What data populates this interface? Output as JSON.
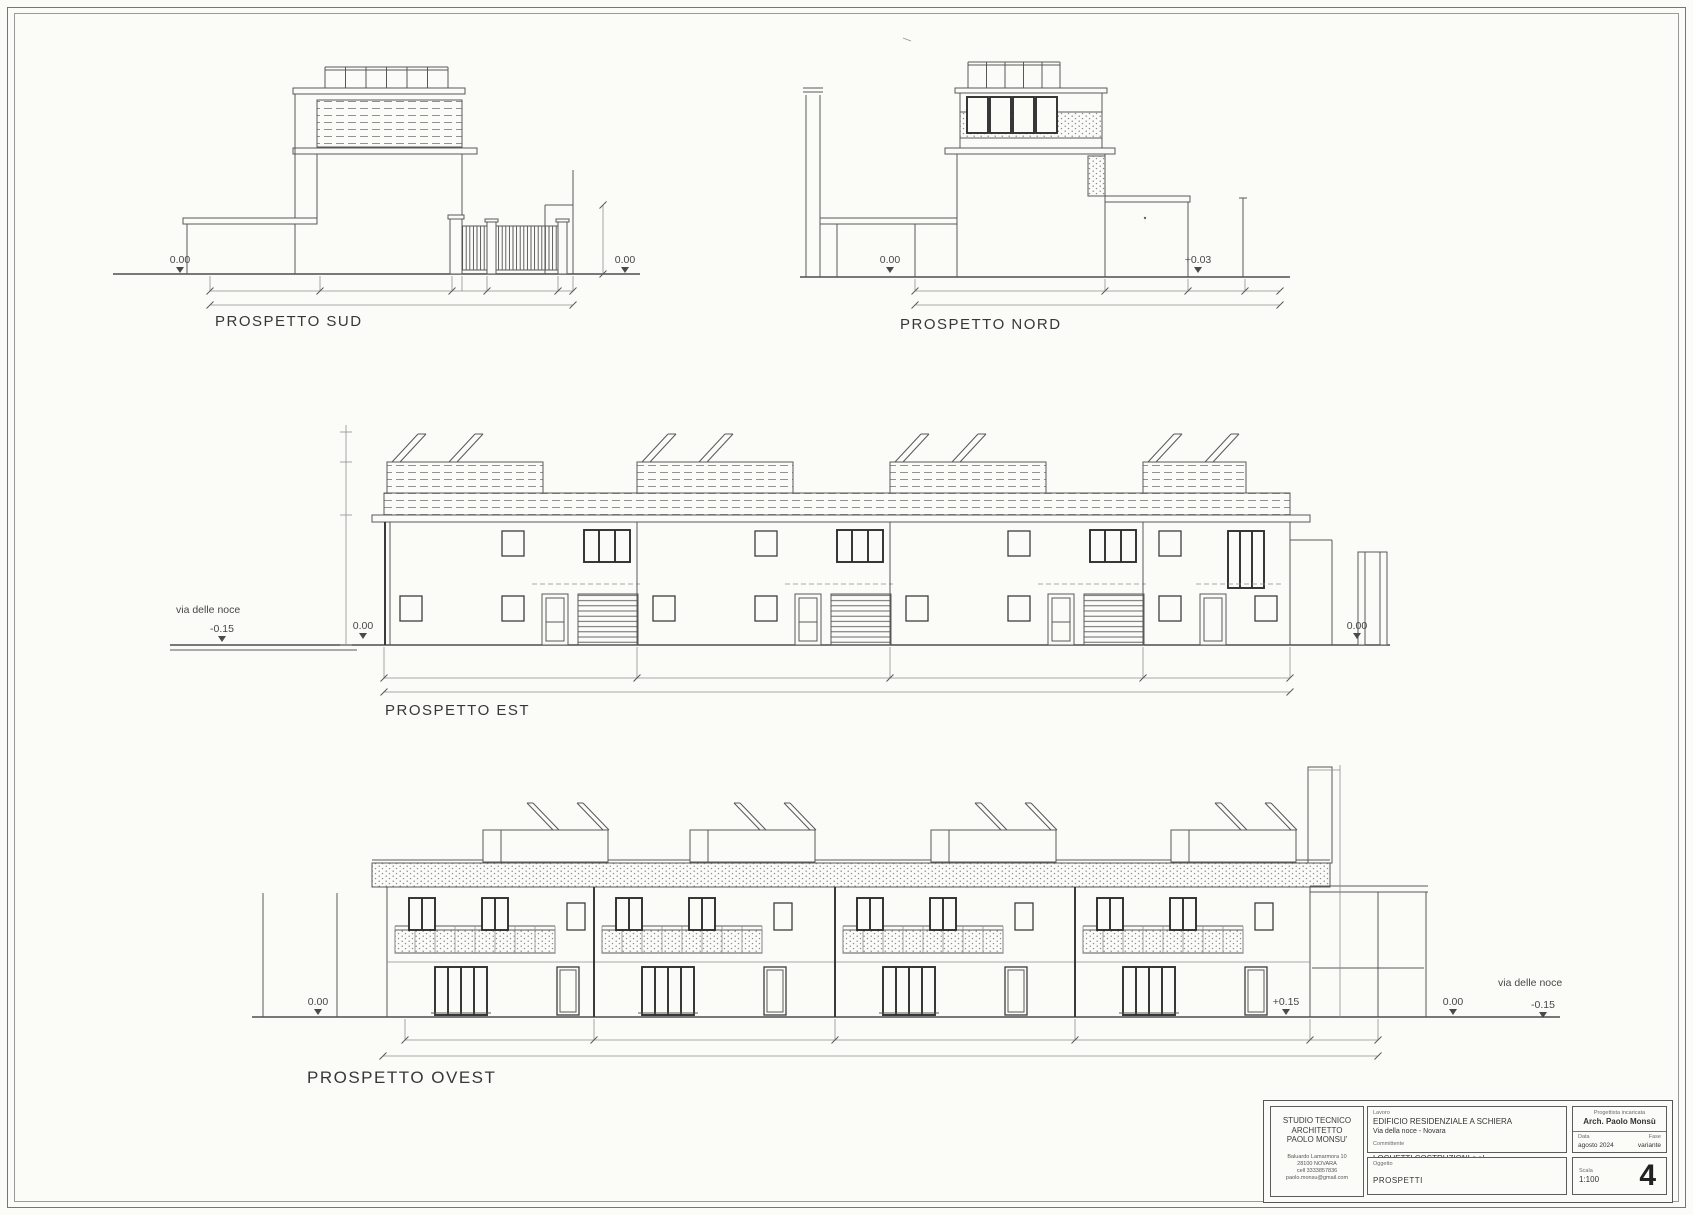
{
  "palette": {
    "paper": "#fbfbf8",
    "ink": "#4a4a4a"
  },
  "elevations": {
    "sud": {
      "label": "PROSPETTO SUD",
      "levels": [
        "0.00",
        "0.00"
      ]
    },
    "nord": {
      "label": "PROSPETTO NORD",
      "levels": [
        "0.00",
        "+0.03"
      ]
    },
    "est": {
      "label": "PROSPETTO EST",
      "street": "via delle noce",
      "levels": [
        "-0.15",
        "0.00",
        "0.00"
      ]
    },
    "ovest": {
      "label": "PROSPETTO OVEST",
      "street": "via delle noce",
      "levels": [
        "0.00",
        "+0.15",
        "0.00",
        "-0.15"
      ]
    }
  },
  "title_block": {
    "studio_line1": "STUDIO TECNICO",
    "studio_line2": "ARCHITETTO",
    "studio_line3": "PAOLO MONSU'",
    "addr1": "Baluardo Lamarmora 10",
    "addr2": "28100    NOVARA",
    "addr3": "cell 3333857836",
    "addr4": "paolo.monsu@gmail.com",
    "lavoro_label": "Lavoro",
    "lavoro_value1": "EDIFICIO RESIDENZIALE A SCHIERA",
    "lavoro_value2": "Via della noce - Novara",
    "committente_label": "Committente",
    "committente_value": "LOCHETTI COSTRUZIONI s.r.l.",
    "oggetto_label": "Oggetto",
    "oggetto_value": "PROSPETTI",
    "progettista_label": "Progettista incaricata",
    "progettista_value": "Arch. Paolo Monsù",
    "data_label": "Data",
    "data_value": "agosto 2024",
    "fase_label": "Fase",
    "fase_value": "variante",
    "scala_label": "Scala",
    "scala_value": "1:100",
    "sheet_number": "4"
  }
}
